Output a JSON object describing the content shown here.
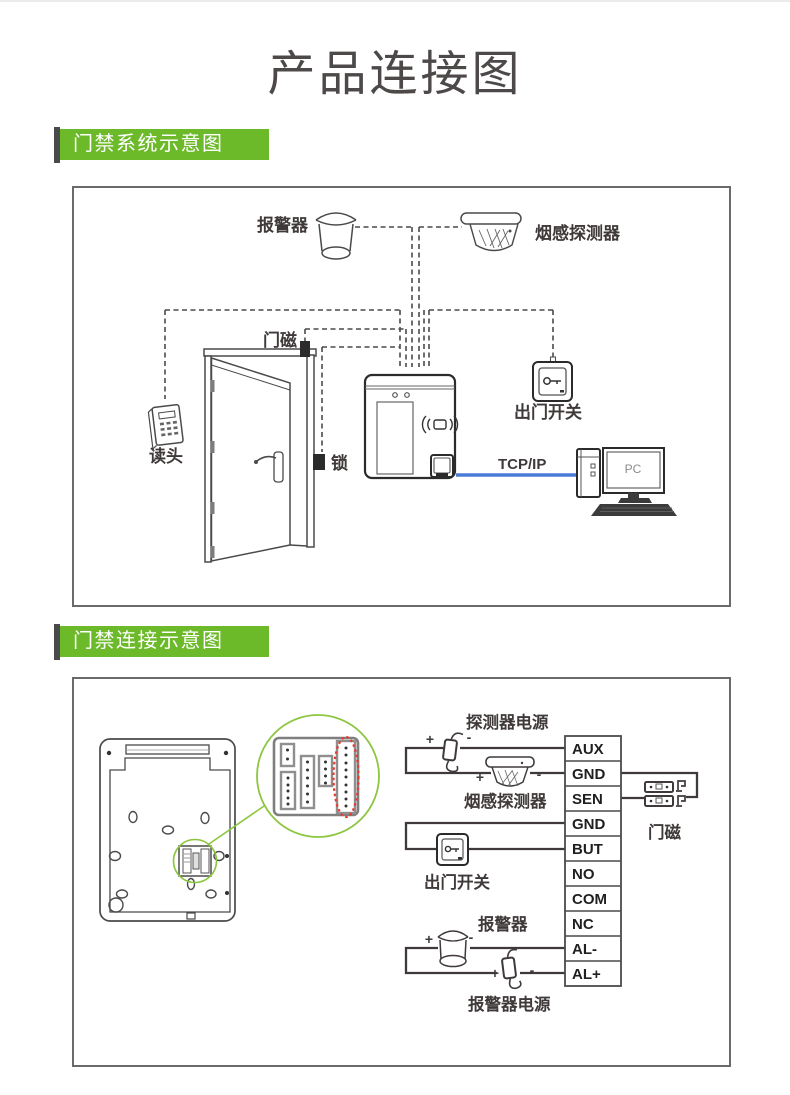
{
  "page": {
    "title": "产品连接图"
  },
  "sections": {
    "system": {
      "badge": "门禁系统示意图"
    },
    "connection": {
      "badge": "门禁连接示意图"
    }
  },
  "system_diagram": {
    "labels": {
      "alarm": "报警器",
      "smoke_detector": "烟感探测器",
      "door_magnet": "门磁",
      "reader": "读头",
      "lock": "锁",
      "exit_switch": "出门开关",
      "tcpip": "TCP/IP",
      "pc": "PC"
    }
  },
  "connection_diagram": {
    "terminals": [
      "AUX",
      "GND",
      "SEN",
      "GND",
      "BUT",
      "NO",
      "COM",
      "NC",
      "AL-",
      "AL+"
    ],
    "labels": {
      "detector_power": "探测器电源",
      "smoke_detector": "烟感探测器",
      "exit_switch": "出门开关",
      "door_magnet": "门磁",
      "alarm": "报警器",
      "alarm_power": "报警器电源"
    },
    "signs": {
      "plus": "+",
      "minus": "-"
    }
  },
  "colors": {
    "accent_green": "#6cba29",
    "callout_green": "#8cc63f",
    "badge_bar": "#4a4a4a",
    "link_blue": "#4a7cd6",
    "highlight_red": "#e8392f"
  }
}
